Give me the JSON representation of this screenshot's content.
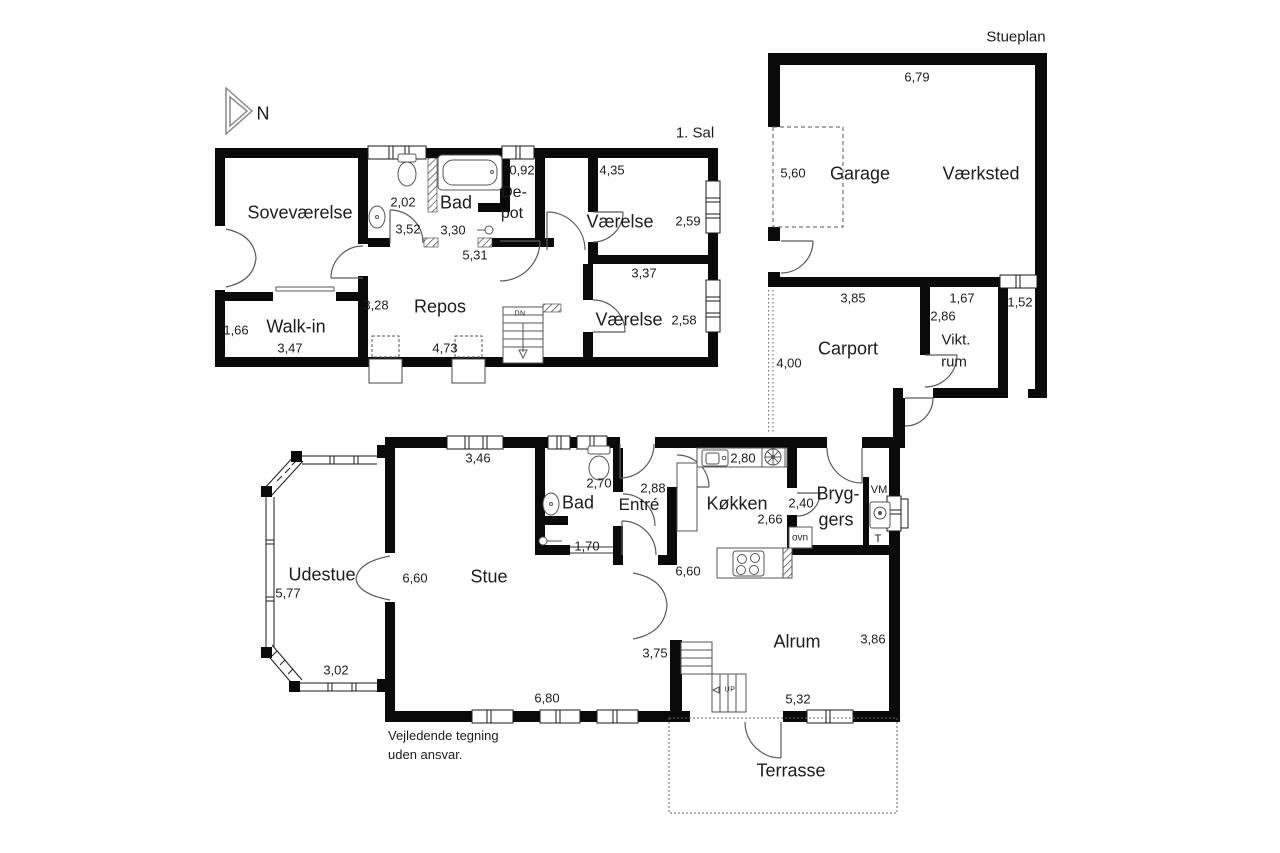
{
  "compass": {
    "north": "N"
  },
  "disclaimer": {
    "line1": "Vejledende tegning",
    "line2": "uden ansvar."
  },
  "colors": {
    "wall": "#0a0a0a",
    "fixture_line": "#555555",
    "text": "#1c1c1c"
  },
  "first_floor": {
    "title": "1. Sal",
    "rooms": {
      "sovevaerelse": {
        "name": "Soveværelse",
        "d1": "3,52"
      },
      "bad": {
        "name": "Bad",
        "d1": "2,02",
        "d2": "3,30"
      },
      "depot": {
        "name_line1": "De-",
        "name_line2": "pot",
        "d1": "0,92"
      },
      "vaerelse_ne": {
        "name": "Værelse",
        "d1": "4,35",
        "d2": "2,59"
      },
      "vaerelse_se": {
        "name": "Værelse",
        "d1": "3,37",
        "d2": "2,58"
      },
      "repos": {
        "name": "Repos",
        "d1": "3,28",
        "d2": "5,31",
        "d3": "4,73"
      },
      "walkin": {
        "name": "Walk-in",
        "d1": "1,66",
        "d2": "3,47"
      },
      "stairs": {
        "label": "DN"
      }
    }
  },
  "ground_floor": {
    "title": "Stueplan",
    "rooms": {
      "garage": {
        "name": "Garage",
        "d1": "5,60"
      },
      "vaerksted": {
        "name": "Værksted",
        "d1": "6,79"
      },
      "carport": {
        "name": "Carport",
        "d1": "3,85",
        "d2": "4,00"
      },
      "viktualierum": {
        "name_line1": "Vikt.",
        "name_line2": "rum",
        "d1": "1,67",
        "d2": "2,86"
      },
      "niche": {
        "d1": "1,52"
      },
      "udestue": {
        "name": "Udestue",
        "d1": "5,77",
        "d2": "3,02"
      },
      "stue": {
        "name": "Stue",
        "d1": "3,46",
        "d2": "6,60",
        "d3": "6,80"
      },
      "bad": {
        "name": "Bad",
        "d1": "2,70",
        "d2": "1,70"
      },
      "entre": {
        "name": "Entré",
        "d1": "2,88"
      },
      "kokken": {
        "name": "Køkken",
        "d1": "2,80",
        "d2": "2,66"
      },
      "bryggers": {
        "name_line1": "Bryg-",
        "name_line2": "gers",
        "d1": "2,40",
        "washer": "VM",
        "dryer": "T",
        "oven": "ovn"
      },
      "alrum": {
        "name": "Alrum",
        "d1": "6,60",
        "d2": "3,75",
        "d3": "3,86",
        "d4": "5,32"
      },
      "terrasse": {
        "name": "Terrasse"
      },
      "stairs": {
        "label": "UP"
      }
    }
  }
}
